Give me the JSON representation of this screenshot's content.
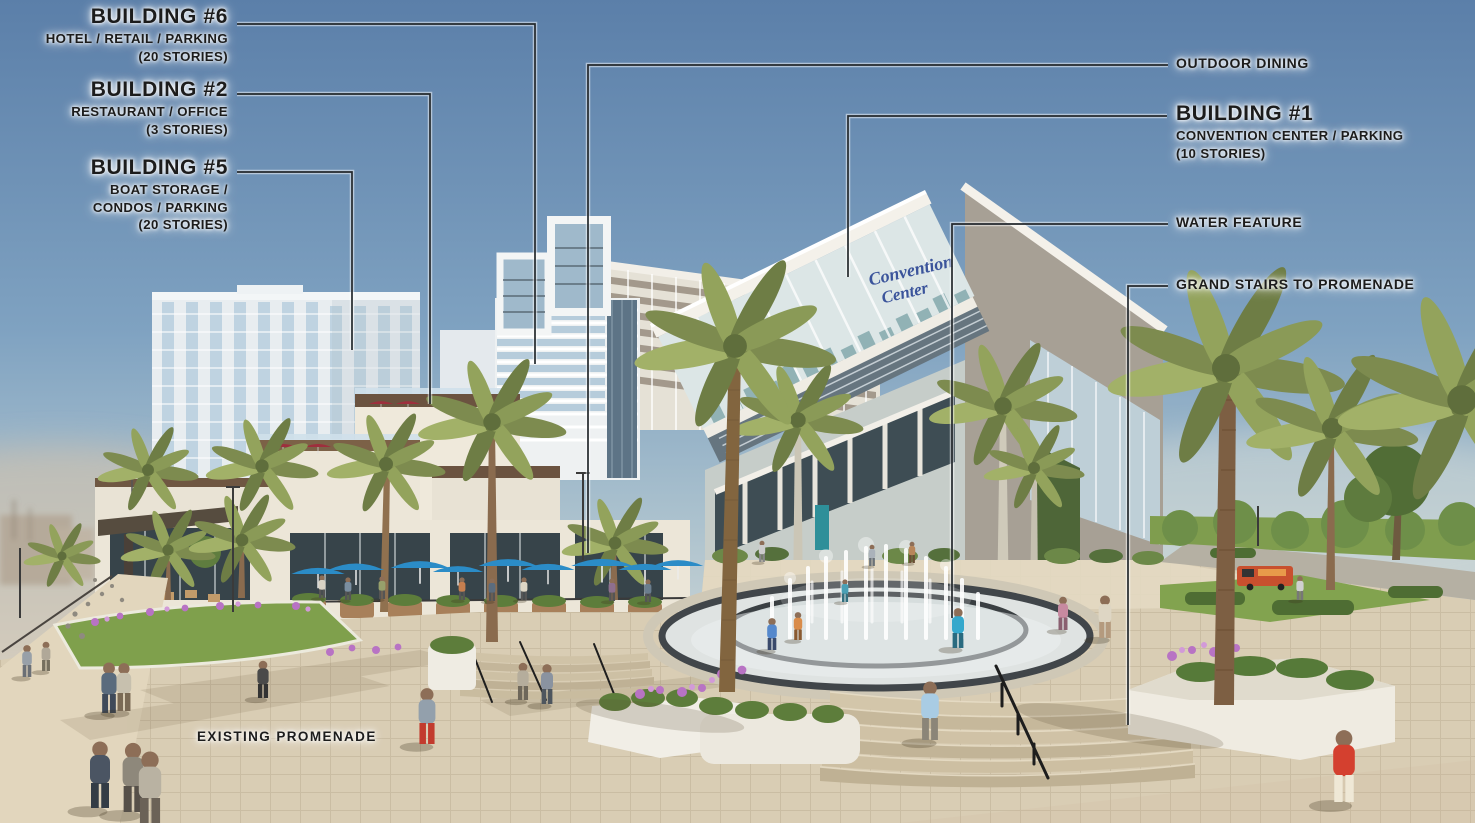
{
  "annotations": {
    "building6": {
      "title": "BUILDING #6",
      "lines": [
        "HOTEL / RETAIL / PARKING",
        "(20 STORIES)"
      ]
    },
    "building2": {
      "title": "BUILDING #2",
      "lines": [
        "RESTAURANT / OFFICE",
        "(3 STORIES)"
      ]
    },
    "building5": {
      "title": "BUILDING #5",
      "lines": [
        "BOAT STORAGE /",
        "CONDOS / PARKING",
        "(20 STORIES)"
      ]
    },
    "building1": {
      "title": "BUILDING #1",
      "lines": [
        "CONVENTION CENTER / PARKING",
        "(10 STORIES)"
      ]
    },
    "outdoor_dining": "OUTDOOR DINING",
    "water_feature": "WATER FEATURE",
    "grand_stairs": "GRAND STAIRS TO PROMENADE",
    "existing_promenade": "EXISTING PROMENADE"
  },
  "scene": {
    "sign": {
      "line1": "Convention",
      "line2": "Center"
    },
    "colors": {
      "leader_line": "#23282c",
      "label_text": "#1c1c1c",
      "sign_blue": "#3b549b",
      "umbrella_blue": "#2b8cc7",
      "umbrella_red": "#9e2f3d",
      "sky_top": "#5b7fa9",
      "pavement": "#d9cdb4",
      "palm_green": "#7d8b4f",
      "lawn_green": "#7fa04c",
      "red_shirt": "#d4402f"
    }
  }
}
